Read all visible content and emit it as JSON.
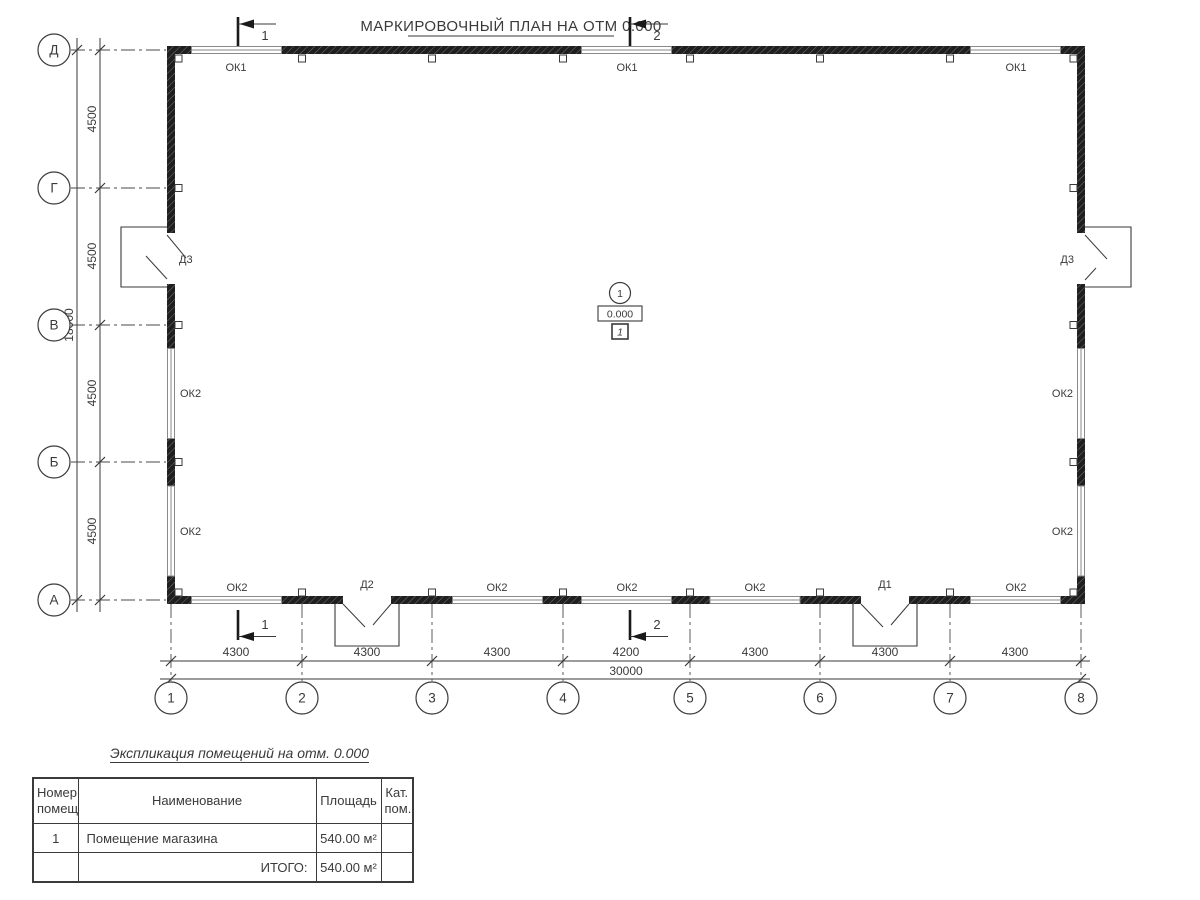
{
  "title": "МАРКИРОВОЧНЫЙ ПЛАН НА ОТМ 0.000",
  "plan": {
    "vertical_axes": [
      "Д",
      "Г",
      "В",
      "Б",
      "А"
    ],
    "horizontal_axes": [
      "1",
      "2",
      "3",
      "4",
      "5",
      "6",
      "7",
      "8"
    ],
    "section_markers": {
      "left": "1",
      "right": "2"
    },
    "center": {
      "axis_mark": "1",
      "elevation": "0.000",
      "room_number": "1"
    },
    "windows": {
      "top": [
        "ОК1",
        "ОК1",
        "ОК1"
      ],
      "bottom": [
        "ОК2",
        "ОК2",
        "ОК2",
        "ОК2",
        "ОК2"
      ],
      "left": [
        "ОК2",
        "ОК2"
      ],
      "right": [
        "ОК2",
        "ОК2"
      ]
    },
    "doors": {
      "left": "Д3",
      "right": "Д3",
      "bottom_left": "Д2",
      "bottom_right": "Д1"
    },
    "dimensions": {
      "bottom_segments": [
        "4300",
        "4300",
        "4300",
        "4200",
        "4300",
        "4300",
        "4300"
      ],
      "bottom_total": "30000",
      "left_segments": [
        "4500",
        "4500",
        "4500",
        "4500"
      ],
      "left_total": "18000"
    }
  },
  "legend_table": {
    "title": "Экспликация помещений на отм. 0.000",
    "headers": [
      "Номер помещ.",
      "Наименование",
      "Площадь",
      "Кат. пом."
    ],
    "rows": [
      {
        "number": "1",
        "name": "Помещение магазина",
        "area": "540.00 м²",
        "category": ""
      },
      {
        "number": "",
        "name": "ИТОГО:",
        "area": "540.00 м²",
        "category": ""
      }
    ]
  },
  "colors": {
    "line": "#3a3a3a",
    "wall": "#1f1f1f",
    "window": "#8a8a8a",
    "background": "#ffffff"
  }
}
